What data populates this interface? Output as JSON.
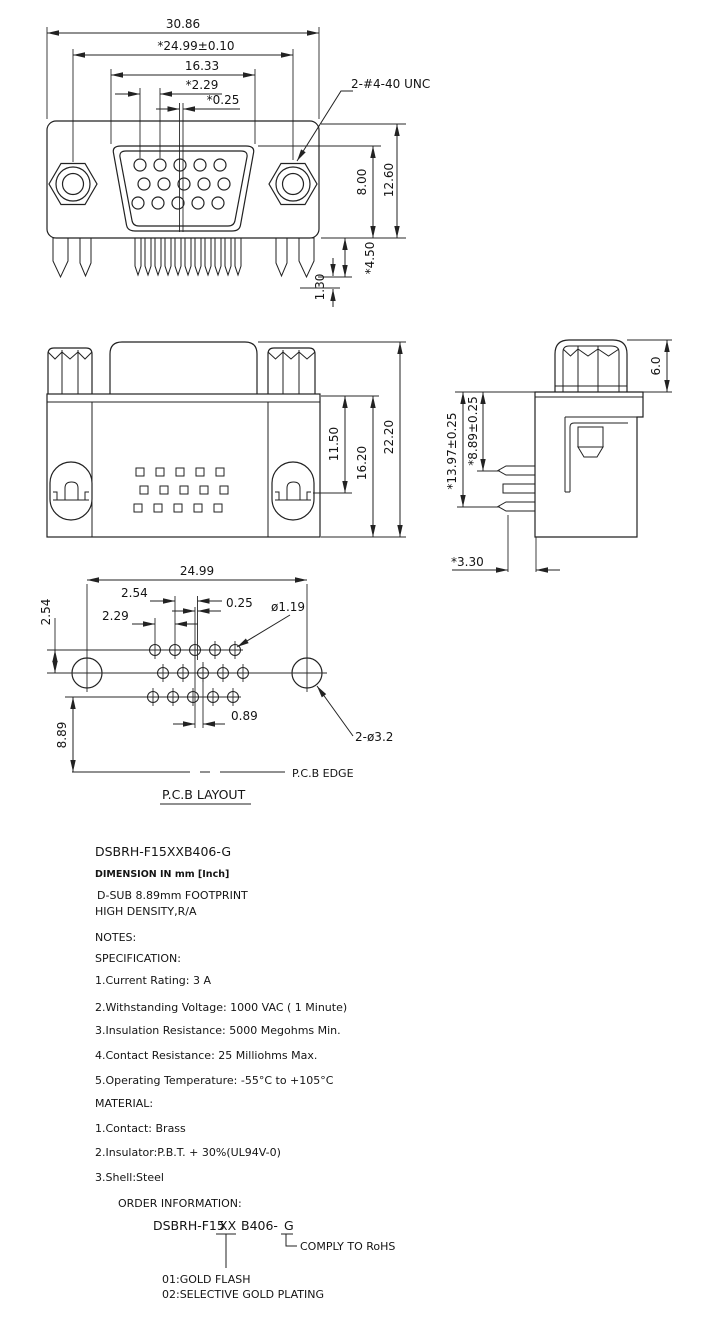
{
  "front_view": {
    "dim_overall_width": "30.86",
    "dim_mount_span": "*24.99±0.10",
    "dim_shroud_width": "16.33",
    "dim_pin_pitch": "*2.29",
    "dim_row_offset": "*0.25",
    "thread_callout": "2-#4-40 UNC",
    "dim_shroud_height": "8.00",
    "dim_overall_height": "12.60",
    "dim_pin_length": "*4.50",
    "dim_pin_tip": "1.30"
  },
  "rear_view": {
    "dim_inner_height": "11.50",
    "dim_body_height": "16.20",
    "dim_overall_height": "22.20"
  },
  "side_view": {
    "dim_standoff_height": "6.0",
    "dim_total_depth": "*13.97±0.25",
    "dim_footprint_depth": "*8.89±0.25",
    "dim_pin_setback": "*3.30"
  },
  "pcb_layout": {
    "dim_mount_span": "24.99",
    "dim_row_spacing": "2.54",
    "dim_col_spacing": "2.54",
    "dim_center_offset": "0.25",
    "dim_pin_pitch": "2.29",
    "dim_hole_dia": "ø1.19",
    "dim_mid_offset": "0.89",
    "dim_edge_distance": "8.89",
    "dim_mount_hole": "2-ø3.2",
    "edge_label": "P.C.B EDGE",
    "title": "P.C.B LAYOUT"
  },
  "notes": {
    "part_number": "DSBRH-F15XXB406-G",
    "dimension_note": "DIMENSION IN mm [Inch]",
    "description_line1": "D-SUB 8.89mm FOOTPRINT",
    "description_line2": "HIGH DENSITY,R/A",
    "notes_label": "NOTES:",
    "specification_label": "SPECIFICATION:",
    "specs": [
      "1.Current Rating: 3 A",
      "2.Withstanding Voltage: 1000 VAC ( 1 Minute)",
      "3.Insulation Resistance: 5000 Megohms Min.",
      "4.Contact Resistance: 25 Milliohms Max.",
      "5.Operating Temperature: -55°C to +105°C"
    ],
    "material_label": "MATERIAL:",
    "materials": [
      "1.Contact: Brass",
      "2.Insulator:P.B.T. + 30%(UL94V-0)",
      "3.Shell:Steel"
    ]
  },
  "order_info": {
    "label": "ORDER INFORMATION:",
    "part_prefix": "DSBRH-F15",
    "part_plating_code": "XX",
    "part_suffix": "B406-",
    "part_rohs_code": "G",
    "rohs_note": "COMPLY TO RoHS",
    "plating_option1": "01:GOLD FLASH",
    "plating_option2": "02:SELECTIVE GOLD PLATING"
  }
}
